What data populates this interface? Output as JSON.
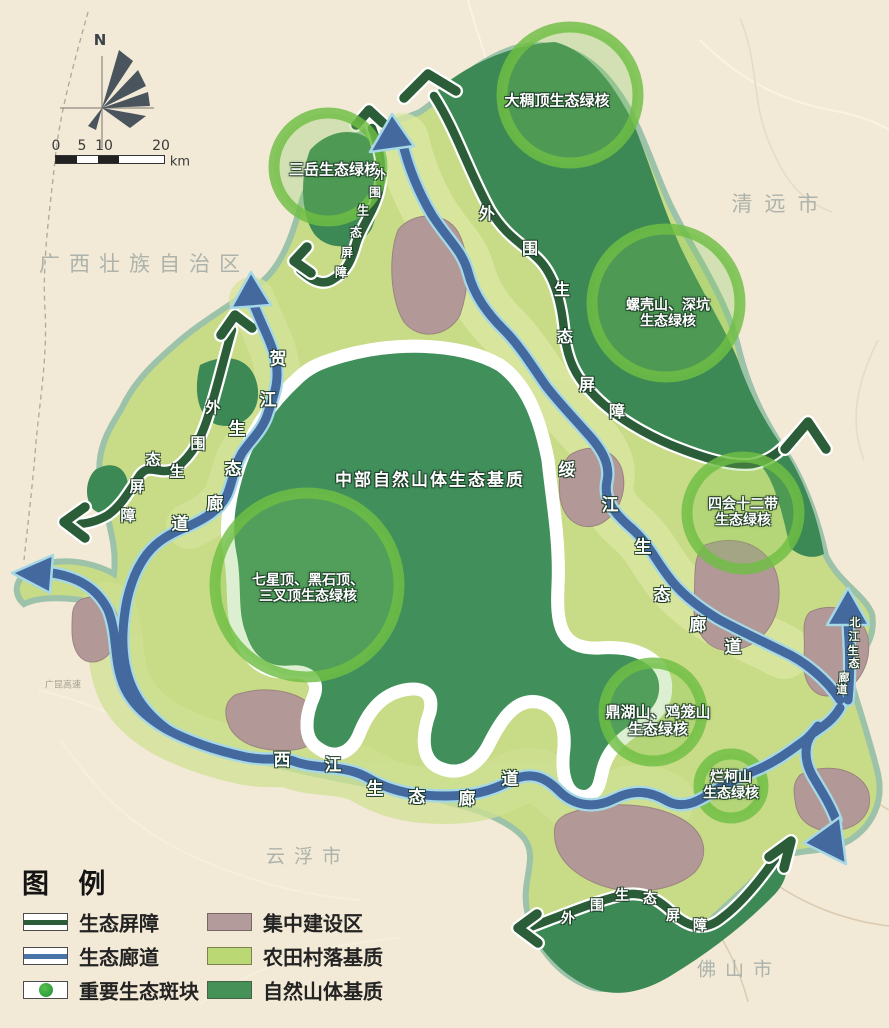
{
  "compass": {
    "north_label": "N"
  },
  "scalebar": {
    "tick0": "0",
    "tick1": "5",
    "tick2": "10",
    "tick3": "20",
    "unit": "km"
  },
  "cities": {
    "guangxi": "广西壮族自治区",
    "qingyuan": "清远市",
    "yunfu": "云浮市",
    "foshan": "佛山市"
  },
  "roads": {
    "guangkun": "广昆高速"
  },
  "matrix_label": "中部自然山体生态基质",
  "cores": {
    "dachouding": {
      "line1": "大稠顶生态绿核"
    },
    "sanyue": {
      "line1": "三岳生态绿核"
    },
    "luoke": {
      "line1": "螺壳山、深坑",
      "line2": "生态绿核"
    },
    "sihui": {
      "line1": "四会十二带",
      "line2": "生态绿核"
    },
    "qixing": {
      "line1": "七星顶、黑石顶、",
      "line2": "三叉顶生态绿核"
    },
    "dinghu": {
      "line1": "鼎湖山、鸡笼山",
      "line2": "生态绿核"
    },
    "lanke": {
      "line1": "烂柯山",
      "line2": "生态绿核"
    }
  },
  "path_labels": {
    "outer_barrier_ne": "外围生态屏障",
    "outer_barrier_nw": "外围生态屏障",
    "outer_barrier_w": "外围生态屏障",
    "outer_barrier_s": "外围生态屏障",
    "hejiang_corridor": "贺江生态廊道",
    "suijiang_corridor": "绥江生态廊道",
    "xijiang_corridor": "西江生态廊道",
    "beijiang_corridor": "北江生态廊道"
  },
  "legend": {
    "title": "图 例",
    "items": [
      {
        "label": "生态屏障",
        "symbol": "barrier-line",
        "color": "#2b5e38"
      },
      {
        "label": "生态廊道",
        "symbol": "corridor-line",
        "color": "#4a74a8"
      },
      {
        "label": "重要生态斑块",
        "symbol": "green-patch",
        "color": "#35a244"
      },
      {
        "label": "集中建设区",
        "symbol": "area-fill",
        "color": "#b49b9b"
      },
      {
        "label": "农田村落基质",
        "symbol": "area-fill",
        "color": "#bad873"
      },
      {
        "label": "自然山体基质",
        "symbol": "area-fill",
        "color": "#459158"
      }
    ]
  },
  "colors": {
    "background": "#f2e9d6",
    "farmland_matrix": "#c8db86",
    "mountain_matrix": "#3f8c57",
    "built_area": "#b49b97",
    "eco_barrier": "#2b5e38",
    "eco_corridor": "#44699f",
    "core_ring": "#72bf44",
    "boundary_line": "#8e5a50",
    "city_label": "#adb3ab"
  }
}
